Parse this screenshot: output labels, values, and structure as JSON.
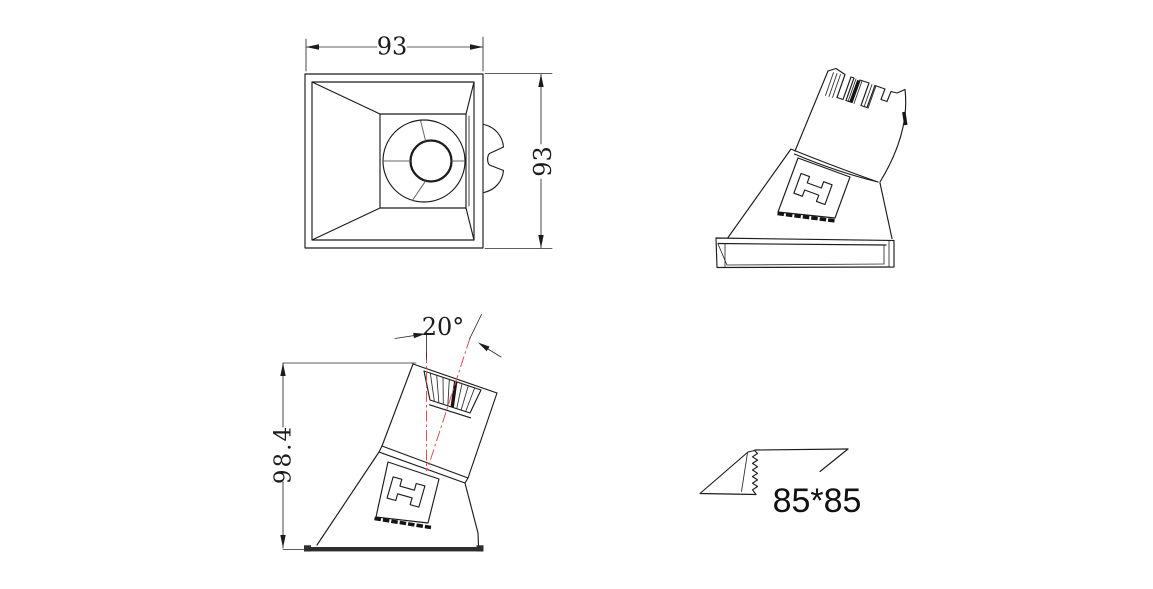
{
  "drawing": {
    "dims": {
      "top_width": "93",
      "top_height": "93",
      "side_height": "98.4",
      "tilt_angle": "20°",
      "cutout_size": "85*85"
    },
    "colors": {
      "line": "#1c1c1c",
      "centerline": "#e05252",
      "background": "#ffffff"
    }
  }
}
